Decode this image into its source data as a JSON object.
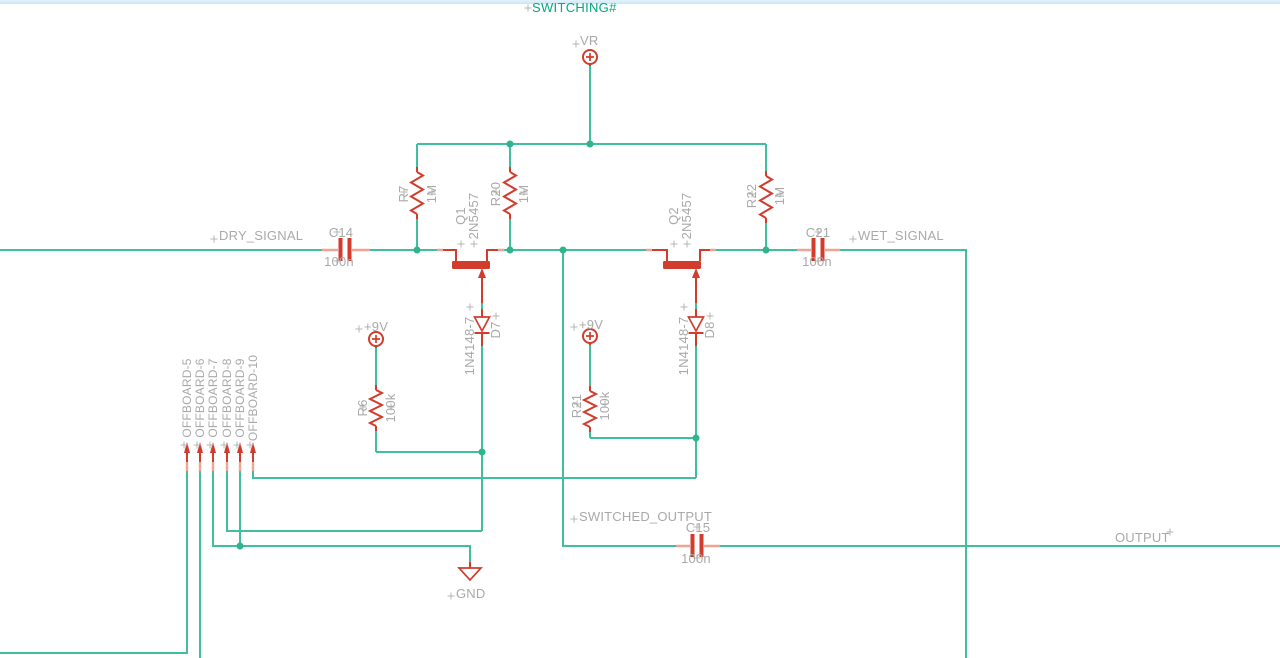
{
  "app": {
    "view": "schematic-canvas",
    "top_edge_color": "#c9e6f6",
    "background_color": "#ffffff"
  },
  "colors": {
    "wire": "#3fbf9c",
    "component": "#d23c2c",
    "pin_stub": "#efa392",
    "junction": "#2fb48e",
    "label_text": "#a9a9a9",
    "net_label_text": "#00a87f"
  },
  "labels": {
    "switching": "SWITCHING#",
    "vr": "VR",
    "dry_signal": "DRY_SIGNAL",
    "wet_signal": "WET_SIGNAL",
    "switched_output": "SWITCHED_OUTPUT",
    "output": "OUTPUT",
    "gnd": "GND",
    "plus9v": "+9V"
  },
  "components": {
    "c14": {
      "name": "C14",
      "value": "100n"
    },
    "c21": {
      "name": "C21",
      "value": "100n"
    },
    "c15": {
      "name": "C15",
      "value": "100n"
    },
    "r7": {
      "name": "R7",
      "value": "1M"
    },
    "r20": {
      "name": "R20",
      "value": "1M"
    },
    "r22": {
      "name": "R22",
      "value": "1M"
    },
    "r6": {
      "name": "R6",
      "value": "100k"
    },
    "r21": {
      "name": "R21",
      "value": "100k"
    },
    "q1": {
      "name": "Q1",
      "value": "2N5457"
    },
    "q2": {
      "name": "Q2",
      "value": "2N5457"
    },
    "d7": {
      "name": "D7",
      "value": "1N4148-7"
    },
    "d8": {
      "name": "D8",
      "value": "1N4148-7"
    }
  },
  "connector": {
    "pins": [
      "OFFBOARD-5",
      "OFFBOARD-6",
      "OFFBOARD-7",
      "OFFBOARD-8",
      "OFFBOARD-9",
      "OFFBOARD-10"
    ]
  }
}
